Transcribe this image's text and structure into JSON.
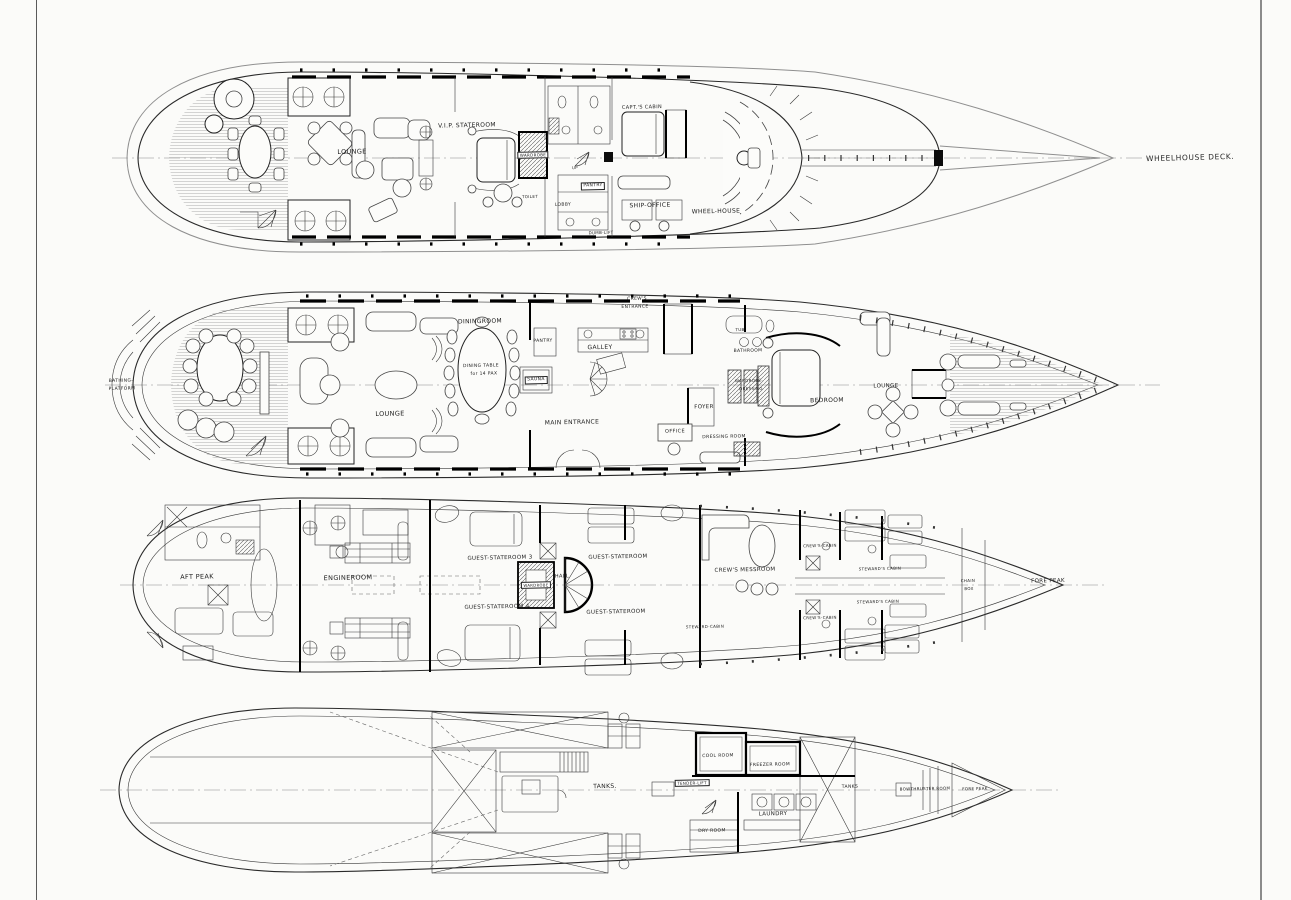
{
  "document": {
    "type": "yacht-deck-plans",
    "sheet_background": "#fbfbf9",
    "ink": "#1c1c1c"
  },
  "decks": [
    {
      "id": "wheelhouse-deck",
      "annotation": "WHEELHOUSE DECK.",
      "labels": [
        {
          "text": "LOUNGE",
          "x": 352,
          "y": 152,
          "fs": 6.5
        },
        {
          "text": "V.I.P. STATEROOM",
          "x": 467,
          "y": 126,
          "fs": 6
        },
        {
          "text": "WARDROBE",
          "x": 533,
          "y": 155,
          "fs": 4,
          "box": true
        },
        {
          "text": "TOILET",
          "x": 530,
          "y": 197,
          "fs": 4
        },
        {
          "text": "PANTRY",
          "x": 593,
          "y": 186,
          "fs": 4.5,
          "box": true
        },
        {
          "text": "LOBBY",
          "x": 563,
          "y": 206,
          "fs": 4.5
        },
        {
          "text": "UP",
          "x": 575,
          "y": 168,
          "fs": 4
        },
        {
          "text": "CAPT.'S CABIN",
          "x": 642,
          "y": 108,
          "fs": 5
        },
        {
          "text": "SHIP-OFFICE",
          "x": 650,
          "y": 206,
          "fs": 6
        },
        {
          "text": "WHEEL-HOUSE",
          "x": 716,
          "y": 212,
          "fs": 6
        },
        {
          "text": "DUMB-LIFT",
          "x": 601,
          "y": 233,
          "fs": 4
        }
      ]
    },
    {
      "id": "main-deck",
      "labels": [
        {
          "text": "BATHING-",
          "x": 121,
          "y": 382,
          "fs": 4.5
        },
        {
          "text": "PLATFORM",
          "x": 122,
          "y": 390,
          "fs": 4.5
        },
        {
          "text": "LOUNGE",
          "x": 390,
          "y": 414,
          "fs": 6.5
        },
        {
          "text": "DININGROOM",
          "x": 480,
          "y": 322,
          "fs": 6
        },
        {
          "text": "DINING TABLE",
          "x": 481,
          "y": 367,
          "fs": 4.5
        },
        {
          "text": "for 14 PAX",
          "x": 484,
          "y": 375,
          "fs": 4.5
        },
        {
          "text": "PANTRY",
          "x": 543,
          "y": 342,
          "fs": 4.5
        },
        {
          "text": "GALLEY",
          "x": 600,
          "y": 348,
          "fs": 6
        },
        {
          "text": "CREW'S",
          "x": 637,
          "y": 300,
          "fs": 4.5
        },
        {
          "text": "ENTRANCE",
          "x": 635,
          "y": 308,
          "fs": 4.5
        },
        {
          "text": "SAUNA",
          "x": 536,
          "y": 380,
          "fs": 4.5,
          "box": true
        },
        {
          "text": "MAIN ENTRANCE",
          "x": 572,
          "y": 423,
          "fs": 6
        },
        {
          "text": "FOYER",
          "x": 704,
          "y": 408,
          "fs": 5.5
        },
        {
          "text": "OFFICE",
          "x": 675,
          "y": 432,
          "fs": 5
        },
        {
          "text": "DRESSING ROOM",
          "x": 724,
          "y": 438,
          "fs": 4.5
        },
        {
          "text": "BATHROOM",
          "x": 748,
          "y": 352,
          "fs": 4.5
        },
        {
          "text": "TUB",
          "x": 740,
          "y": 330,
          "fs": 4
        },
        {
          "text": "WARDROBE-",
          "x": 749,
          "y": 381,
          "fs": 4
        },
        {
          "text": "DRESSING",
          "x": 751,
          "y": 389,
          "fs": 4
        },
        {
          "text": "BEDROOM",
          "x": 827,
          "y": 401,
          "fs": 6
        },
        {
          "text": "LOUNGE",
          "x": 886,
          "y": 387,
          "fs": 5.5
        }
      ]
    },
    {
      "id": "lower-deck",
      "labels": [
        {
          "text": "AFT PEAK",
          "x": 197,
          "y": 577,
          "fs": 6.5
        },
        {
          "text": "ENGINEROOM",
          "x": 348,
          "y": 578,
          "fs": 6.5
        },
        {
          "text": "GUEST-STATEROOM 3",
          "x": 500,
          "y": 559,
          "fs": 5.5
        },
        {
          "text": "GUEST-STATEROOM 4",
          "x": 497,
          "y": 608,
          "fs": 5.5
        },
        {
          "text": "GUEST-STATEROOM",
          "x": 618,
          "y": 558,
          "fs": 5.5
        },
        {
          "text": "GUEST-STATEROOM",
          "x": 616,
          "y": 613,
          "fs": 5.5
        },
        {
          "text": "HALL",
          "x": 562,
          "y": 577,
          "fs": 5
        },
        {
          "text": "WARDROBE",
          "x": 536,
          "y": 585,
          "fs": 3.8,
          "box": true
        },
        {
          "text": "CREW'S MESSROOM",
          "x": 745,
          "y": 571,
          "fs": 5.5
        },
        {
          "text": "CREW'S-CABIN",
          "x": 820,
          "y": 546,
          "fs": 4
        },
        {
          "text": "CREW'S-CABIN",
          "x": 820,
          "y": 618,
          "fs": 4
        },
        {
          "text": "STEWARD'S CABIN",
          "x": 880,
          "y": 569,
          "fs": 4
        },
        {
          "text": "STEWARD'S CABIN",
          "x": 878,
          "y": 602,
          "fs": 4
        },
        {
          "text": "STEWARD-CABIN",
          "x": 705,
          "y": 627,
          "fs": 4
        },
        {
          "text": "CHAIN",
          "x": 968,
          "y": 581,
          "fs": 4
        },
        {
          "text": "BOX",
          "x": 969,
          "y": 589,
          "fs": 4
        },
        {
          "text": "FORE PEAK",
          "x": 1048,
          "y": 582,
          "fs": 5.5
        }
      ]
    },
    {
      "id": "tank-deck",
      "labels": [
        {
          "text": "TANKS.",
          "x": 605,
          "y": 787,
          "fs": 6
        },
        {
          "text": "TENDER-LIFT",
          "x": 692,
          "y": 783,
          "fs": 4,
          "box": true
        },
        {
          "text": "COOL ROOM",
          "x": 718,
          "y": 757,
          "fs": 4.5
        },
        {
          "text": "FREEZER ROOM",
          "x": 770,
          "y": 766,
          "fs": 4.5
        },
        {
          "text": "LAUNDRY",
          "x": 773,
          "y": 815,
          "fs": 5.5
        },
        {
          "text": "DRY ROOM",
          "x": 712,
          "y": 832,
          "fs": 4.5
        },
        {
          "text": "TANKS",
          "x": 850,
          "y": 788,
          "fs": 4.5
        },
        {
          "text": "BOWTHRUSTER ROOM",
          "x": 925,
          "y": 789,
          "fs": 4
        },
        {
          "text": "FORE PEAK",
          "x": 975,
          "y": 789,
          "fs": 4
        }
      ]
    }
  ]
}
